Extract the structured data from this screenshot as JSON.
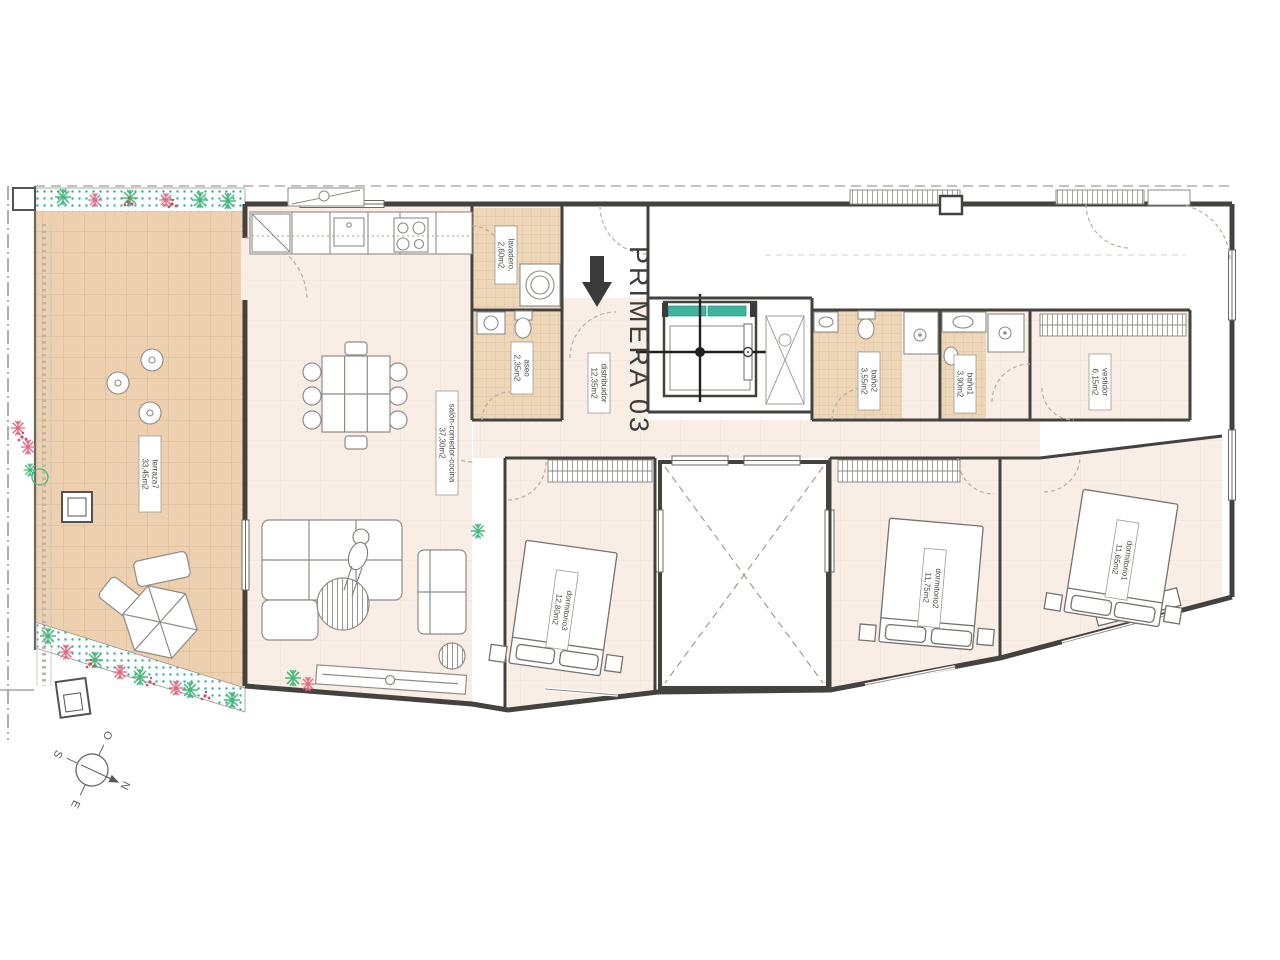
{
  "title": {
    "text": "PRIMERA 03"
  },
  "compass": {
    "north": "N",
    "south": "S",
    "east": "E",
    "west": "O"
  },
  "rooms": [
    {
      "id": "terraza",
      "name": "terraza7",
      "area": "33,45m2"
    },
    {
      "id": "salon",
      "name": "salón-comedor-cocina",
      "area": "37,30m2"
    },
    {
      "id": "lavadero",
      "name": "lavadero,",
      "area": "2,60m2"
    },
    {
      "id": "aseo",
      "name": "aseo",
      "area": "2,35m2"
    },
    {
      "id": "distribuidor",
      "name": "distribuidor",
      "area": "12,35m2"
    },
    {
      "id": "banyo2",
      "name": "baño2",
      "area": "3,55m2"
    },
    {
      "id": "banyo1",
      "name": "baño1",
      "area": "3,90m2"
    },
    {
      "id": "vestidor",
      "name": "vestidor",
      "area": "6,15m2"
    },
    {
      "id": "dormitorio3",
      "name": "dormitorio3",
      "area": "12,80m2"
    },
    {
      "id": "dormitorio2",
      "name": "dormitorio2",
      "area": "11,75m2"
    },
    {
      "id": "dormitorio1",
      "name": "dormitorio1",
      "area": "11,65m2"
    }
  ],
  "colors": {
    "wall": "#44423e",
    "floor": "#f8eee6",
    "tile": "#ecd0af",
    "tile_line": "#d9b88f",
    "elevator_door": "#3eb39e",
    "planter_dot": "#35b09a",
    "plant_green": "#46b97c",
    "plant_pink": "#e4677f",
    "flower_red": "#d8485f"
  }
}
